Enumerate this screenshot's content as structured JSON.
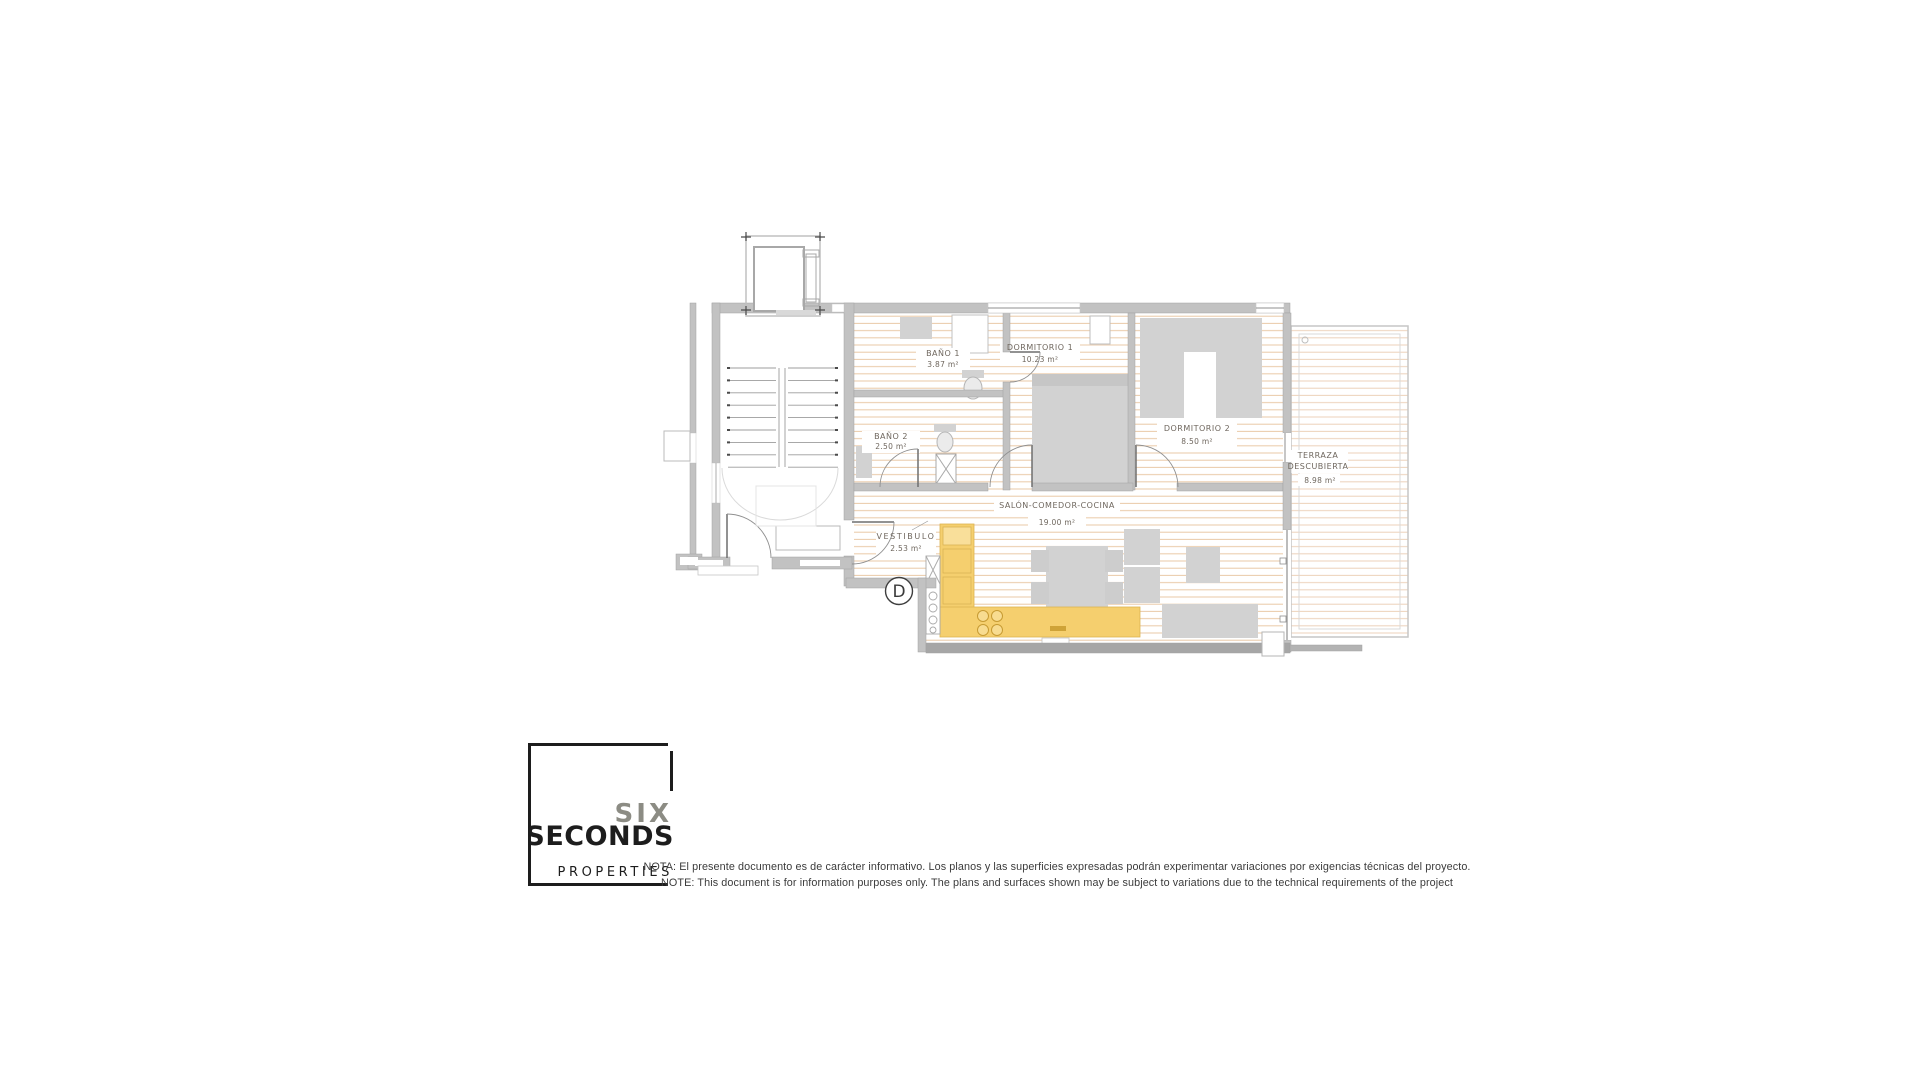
{
  "plan": {
    "unit_label": "D",
    "rooms": {
      "bano1": {
        "name": "BAÑO 1",
        "area": "3.87 m²"
      },
      "bano2": {
        "name": "BAÑO 2",
        "area": "2.50 m²"
      },
      "dormitorio1": {
        "name": "DORMITORIO 1",
        "area": "10.23 m²"
      },
      "dormitorio2": {
        "name": "DORMITORIO 2",
        "area": "8.50 m²"
      },
      "salon": {
        "name": "SALÓN-COMEDOR-COCINA",
        "area": "19.00 m²"
      },
      "vestibulo": {
        "name": "VESTIBULO",
        "area": "2.53 m²"
      },
      "terraza": {
        "name_line1": "TERRAZA",
        "name_line2": "DESCUBIERTA",
        "area": "8.98 m²"
      }
    }
  },
  "logo": {
    "word_top": "SIX",
    "word_main": "SECONDS",
    "word_sub": "PROPERTIES"
  },
  "disclaimer": {
    "line_es": "NOTA: El presente documento es de carácter informativo. Los planos y las superficies expresadas podrán experimentar variaciones por exigencias técnicas del proyecto.",
    "line_en": "NOTE: This document is for information purposes only. The plans and surfaces shown may be subject to variations due to the technical requirements of the project"
  },
  "colors": {
    "kitchen": "#f5cf6e",
    "kitchen_light": "#f9df9a",
    "floor_stripe": "#eac9a6",
    "terrace_stripe": "#edd2ba",
    "wall": "#c2c2c2",
    "wall_dark": "#a6a6a6",
    "furniture": "#d2d2d2",
    "label_text": "#6f675e",
    "logo_gray": "#8c8c84",
    "logo_black": "#1d1d1d"
  }
}
